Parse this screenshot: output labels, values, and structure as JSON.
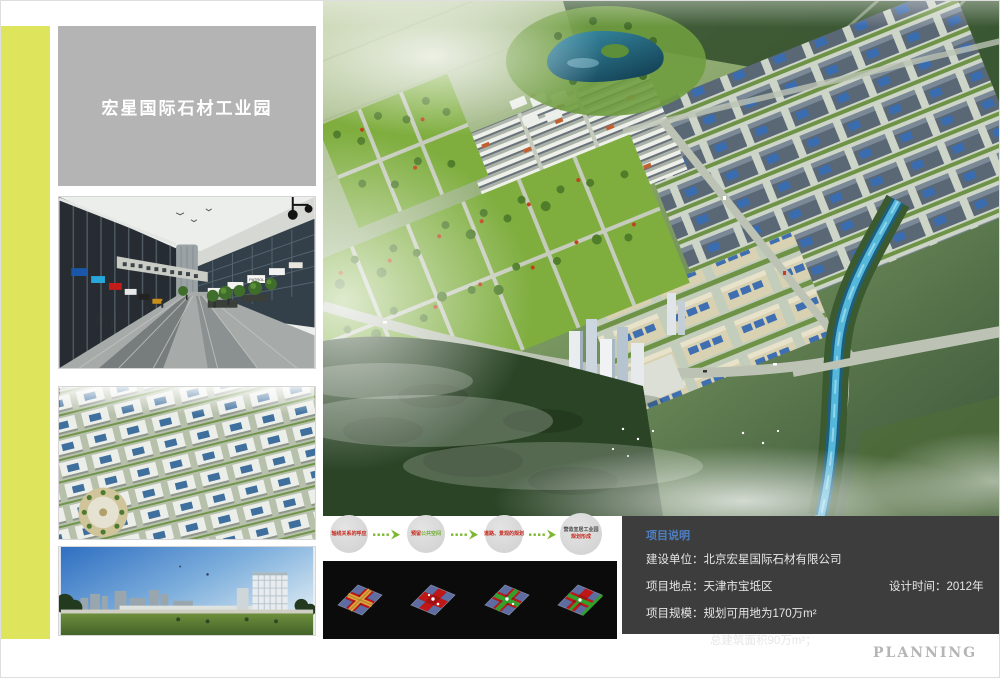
{
  "board": {
    "planning_label": "PLANNING"
  },
  "title_panel": {
    "text": "宏星国际石材工业园"
  },
  "colors": {
    "accent_stripe": "#dee45c",
    "title_bg": "#b4b4b4",
    "info_bg": "#3d3d3d",
    "info_header": "#4d7fc2",
    "flow_red": "#c5281c",
    "flow_green": "#6fae2d",
    "flow_arrow": "#7cb82f"
  },
  "photos": {
    "street": {
      "name": "commercial-street-rendering",
      "sign_label": "PATROL"
    },
    "aerial": {
      "name": "industrial-park-aerial-rendering"
    },
    "skyline": {
      "name": "office-building-rendering"
    }
  },
  "flow": {
    "steps": [
      {
        "spans": [
          {
            "text": "轴线关系的呼应",
            "color": "#c5281c"
          }
        ]
      },
      {
        "spans": [
          {
            "text": "预留",
            "color": "#c5281c"
          },
          {
            "text": "公共空间",
            "color": "#6fae2d"
          }
        ]
      },
      {
        "spans": [
          {
            "text": "道路、景观的规划",
            "color": "#c5281c"
          }
        ]
      },
      {
        "spans": [
          {
            "text": "营造宜居工业园",
            "color": "#4a4a4a"
          },
          {
            "text": "规划形成",
            "color": "#c5281c"
          }
        ]
      }
    ]
  },
  "project_info": {
    "header": "项目说明",
    "rows": [
      {
        "label": "建设单位：",
        "value": "北京宏星国际石材有限公司"
      },
      {
        "label": "项目地点：",
        "value": "天津市宝坻区",
        "right_label": "设计时间：",
        "right_value": "2012年"
      },
      {
        "label": "项目规模：",
        "value": "规划可用地为170万m²"
      },
      {
        "label": "",
        "value": "总建筑面积90万m²；"
      }
    ]
  }
}
